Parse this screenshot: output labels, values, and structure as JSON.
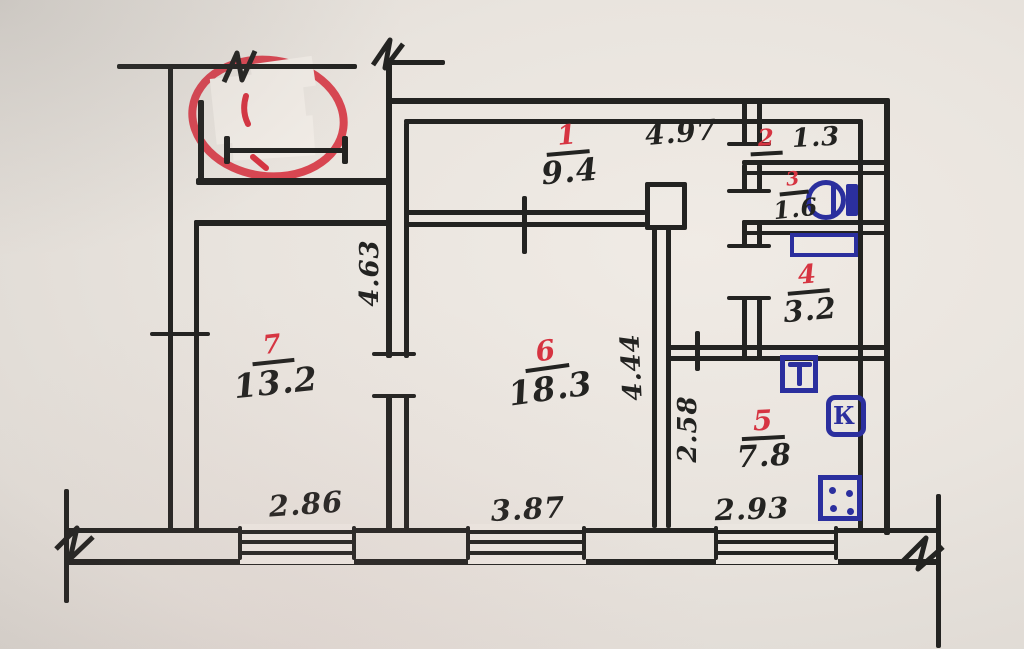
{
  "meta": {
    "title": "Hand-drawn apartment floor plan (BTI sketch photo)"
  },
  "palette": {
    "ink": "#232321",
    "red": "#d63441",
    "blue": "#2b2f9e",
    "paper": "#e9e4de",
    "whiteout": "#f1ece6"
  },
  "rooms": [
    {
      "number": "1",
      "area": "9.4"
    },
    {
      "number": "2",
      "area": "1.3"
    },
    {
      "number": "3",
      "area": "1.6"
    },
    {
      "number": "4",
      "area": "3.2"
    },
    {
      "number": "5",
      "area": "7.8"
    },
    {
      "number": "6",
      "area": "18.3"
    },
    {
      "number": "7",
      "area": "13.2"
    }
  ],
  "dimensions": [
    {
      "id": "top-width",
      "value": "4.97",
      "orientation": "horizontal"
    },
    {
      "id": "left-vertical",
      "value": "4.63",
      "orientation": "vertical"
    },
    {
      "id": "center-vertical",
      "value": "4.44",
      "orientation": "vertical"
    },
    {
      "id": "kitchen-vertical",
      "value": "2.58",
      "orientation": "vertical"
    },
    {
      "id": "window-left",
      "value": "2.86",
      "orientation": "horizontal"
    },
    {
      "id": "window-center",
      "value": "3.87",
      "orientation": "horizontal"
    },
    {
      "id": "window-right",
      "value": "2.93",
      "orientation": "horizontal"
    }
  ],
  "fixtures": {
    "water_heater_label": "К",
    "icons": [
      "washbasin-icon",
      "bathtub-icon",
      "toilet-icon",
      "water-heater-icon",
      "stove-icon",
      "vent-shaft",
      "break-mark-icon",
      "window-symbol",
      "red-scribble"
    ]
  }
}
